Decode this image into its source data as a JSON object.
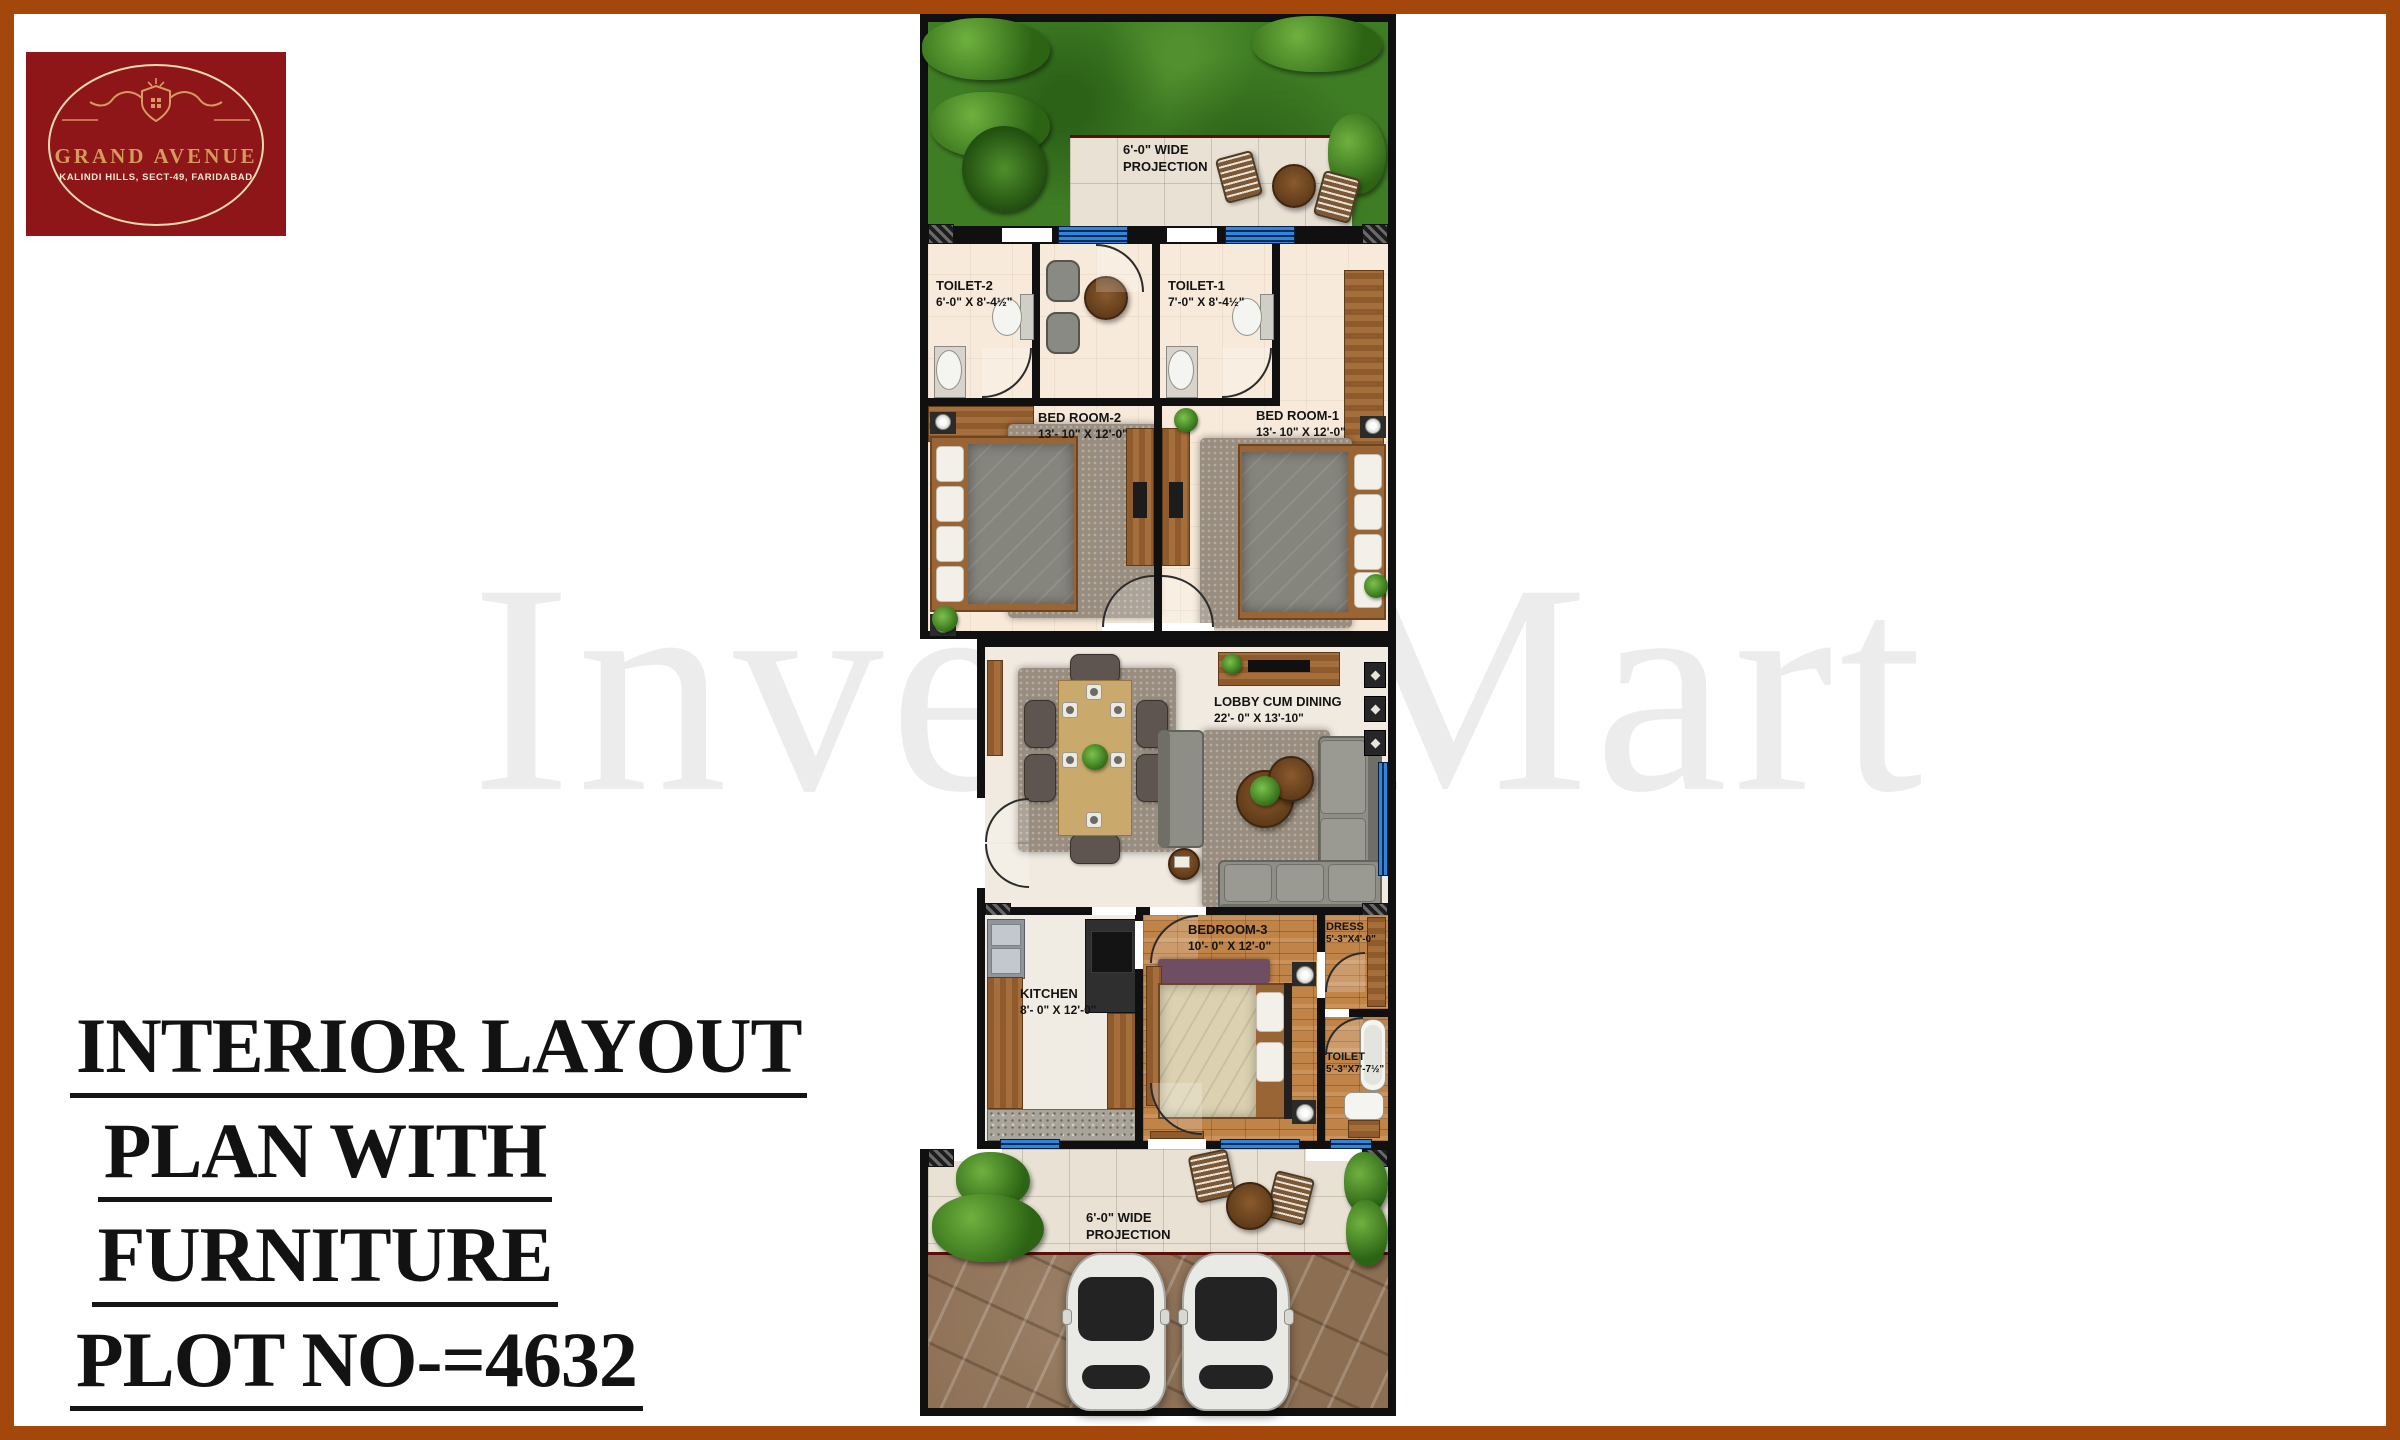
{
  "logo": {
    "title": "GRAND AVENUE",
    "subtitle": "KALINDI HILLS, SECT-49, FARIDABAD"
  },
  "watermark": "Invest Mart",
  "caption": {
    "lines": [
      "INTERIOR LAYOUT",
      "PLAN WITH",
      "FURNITURE",
      "PLOT NO-=4632"
    ]
  },
  "plan": {
    "projection_top": {
      "line1": "6'-0\" WIDE",
      "line2": "PROJECTION"
    },
    "projection_bottom": {
      "line1": "6'-0\" WIDE",
      "line2": "PROJECTION"
    },
    "rooms": {
      "toilet2": {
        "name": "TOILET-2",
        "dims": "6'-0\" X 8'-4½\""
      },
      "toilet1": {
        "name": "TOILET-1",
        "dims": "7'-0\" X 8'-4½\""
      },
      "bedroom2": {
        "name": "BED ROOM-2",
        "dims": "13'- 10\" X 12'-0\""
      },
      "bedroom1": {
        "name": "BED ROOM-1",
        "dims": "13'- 10\" X 12'-0\""
      },
      "lobby": {
        "name": "LOBBY CUM DINING",
        "dims": "22'- 0\" X 13'-10\""
      },
      "kitchen": {
        "name": "KITCHEN",
        "dims": "8'- 0\" X 12'-0\""
      },
      "bedroom3": {
        "name": "BEDROOM-3",
        "dims": "10'- 0\" X 12'-0\""
      },
      "dress": {
        "name": "DRESS",
        "dims": "5'-3\"X4'-0\""
      },
      "toilet3": {
        "name": "TOILET",
        "dims": "5'-3\"X7'-7½\""
      }
    }
  },
  "colors": {
    "frame": "#A3470B",
    "logo_bg": "#8E1518",
    "logo_gold": "#D49A5E",
    "wall": "#101010",
    "window_blue": "#2F86E0",
    "lawn_green": "#3F7D24",
    "floor_beige": "#F7EADA",
    "wood": "#C08348",
    "watermark_gray": "#ECECEC"
  }
}
